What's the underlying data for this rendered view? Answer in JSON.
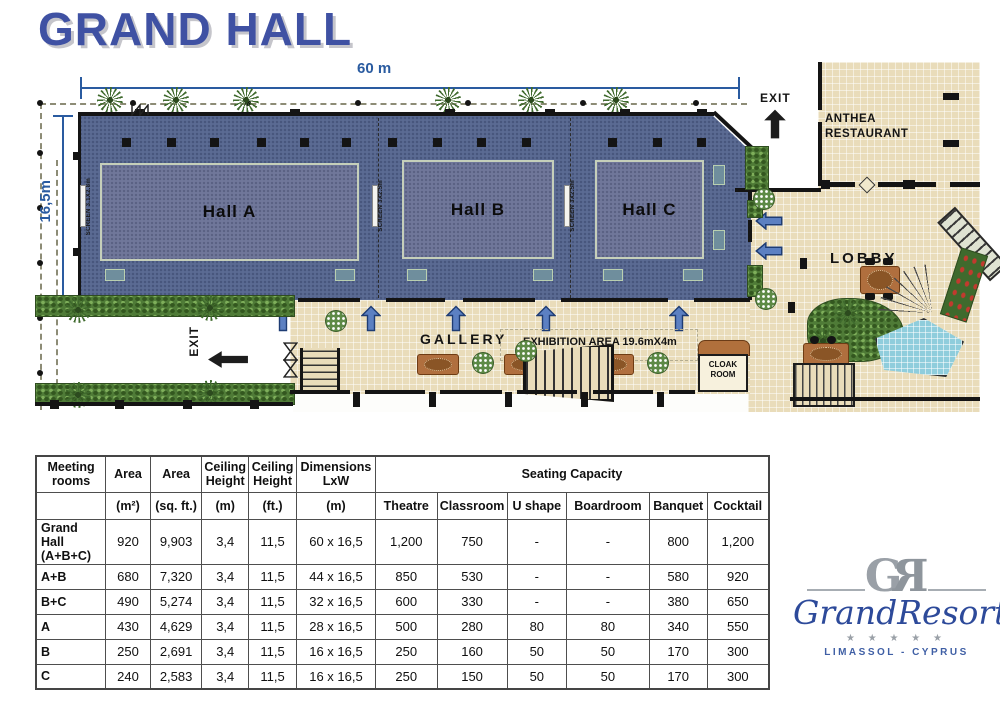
{
  "title": "GRAND HALL",
  "plan": {
    "dim_width": "60 m",
    "dim_height": "16,5m",
    "halls": [
      {
        "name": "Hall A",
        "screen": "SCREEN 3.1X2.8m"
      },
      {
        "name": "Hall B",
        "screen": "SCREEN 3X2.5m"
      },
      {
        "name": "Hall C",
        "screen": "SCREEN 3X2.5m"
      }
    ],
    "labels": {
      "exit_top": "EXIT",
      "exit_left": "EXIT",
      "restaurant_line1": "ANTHEA",
      "restaurant_line2": "RESTAURANT",
      "lobby": "LOBBY",
      "gallery": "GALLERY",
      "exhibition": "EXHIBITION AREA  19.6mX4m",
      "cloak_line1": "CLOAK",
      "cloak_line2": "ROOM"
    }
  },
  "table": {
    "header_row1": [
      "Meeting rooms",
      "Area",
      "Area",
      "Ceiling Height",
      "Ceiling Height",
      "Dimensions LxW",
      "Seating Capacity"
    ],
    "header_row2": [
      "",
      "(m²)",
      "(sq. ft.)",
      "(m)",
      "(ft.)",
      "(m)",
      "Theatre",
      "Classroom",
      "U shape",
      "Boardroom",
      "Banquet",
      "Cocktail"
    ],
    "rows": [
      {
        "cells": [
          "Grand Hall (A+B+C)",
          "920",
          "9,903",
          "3,4",
          "11,5",
          "60 x 16,5",
          "1,200",
          "750",
          "-",
          "-",
          "800",
          "1,200"
        ]
      },
      {
        "cells": [
          "A+B",
          "680",
          "7,320",
          "3,4",
          "11,5",
          "44 x 16,5",
          "850",
          "530",
          "-",
          "-",
          "580",
          "920"
        ]
      },
      {
        "cells": [
          "B+C",
          "490",
          "5,274",
          "3,4",
          "11,5",
          "32 x 16,5",
          "600",
          "330",
          "-",
          "-",
          "380",
          "650"
        ]
      },
      {
        "cells": [
          "A",
          "430",
          "4,629",
          "3,4",
          "11,5",
          "28 x 16,5",
          "500",
          "280",
          "80",
          "80",
          "340",
          "550"
        ]
      },
      {
        "cells": [
          "B",
          "250",
          "2,691",
          "3,4",
          "11,5",
          "16 x 16,5",
          "250",
          "160",
          "50",
          "50",
          "170",
          "300"
        ]
      },
      {
        "cells": [
          "C",
          "240",
          "2,583",
          "3,4",
          "11,5",
          "16 x 16,5",
          "250",
          "150",
          "50",
          "50",
          "170",
          "300"
        ]
      }
    ]
  },
  "logo": {
    "monogram_g": "G",
    "monogram_r": "R",
    "name": "GrandResort",
    "stars": "★ ★ ★ ★ ★",
    "location": "LIMASSOL - CYPRUS"
  },
  "colors": {
    "title_blue": "#3f51a3",
    "dimension_blue": "#2a5ba0",
    "carpet_blue": "#5b6b93",
    "arrow_blue": "#5c80c2",
    "stone": "#e8daae",
    "logo_blue": "#2d4a9a"
  }
}
